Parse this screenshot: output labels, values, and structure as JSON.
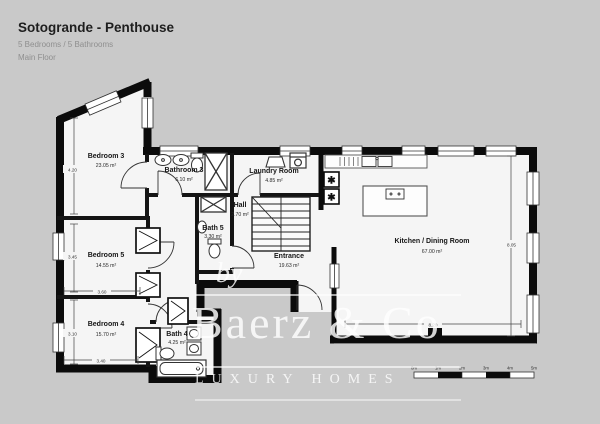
{
  "header": {
    "title": "Sotogrande - Penthouse",
    "subtitle": "5 Bedrooms / 5 Bathrooms",
    "floor": "Main Floor"
  },
  "rooms": [
    {
      "id": "bedroom-3",
      "name": "Bedroom 3",
      "area": "23.05 m²"
    },
    {
      "id": "bathroom-3",
      "name": "Bathroom 3",
      "area": "6.10 m²"
    },
    {
      "id": "laundry",
      "name": "Laundry Room",
      "area": "4.85 m²"
    },
    {
      "id": "hall",
      "name": "Hall",
      "area": "2.70 m²"
    },
    {
      "id": "bath-5",
      "name": "Bath 5",
      "area": "3.30 m²"
    },
    {
      "id": "bedroom-5",
      "name": "Bedroom 5",
      "area": "14.55 m²"
    },
    {
      "id": "entrance",
      "name": "Entrance",
      "area": "19.63 m²"
    },
    {
      "id": "kitchen",
      "name": "Kitchen / Dining Room",
      "area": "67.00 m²"
    },
    {
      "id": "bedroom-4",
      "name": "Bedroom 4",
      "area": "15.70 m²"
    },
    {
      "id": "bath-4",
      "name": "Bath 4",
      "area": "4.25 m²"
    }
  ],
  "dimensions": [
    "4.20",
    "3.45",
    "3.60",
    "3.10",
    "3.40",
    "8.05",
    "8.20"
  ],
  "scale_bar": {
    "labels": [
      "0m",
      "1m",
      "2m",
      "3m",
      "4m",
      "5m"
    ]
  },
  "watermark": {
    "by": "by",
    "name": "Baerz & Co",
    "tagline": "LUXURY HOMES"
  },
  "icons": {
    "snowflake": "✱"
  },
  "colors": {
    "background": "#c9c9c9",
    "floor": "#f5f5f5",
    "wall": "#0b0b0b",
    "watermark": "#ffffff"
  }
}
